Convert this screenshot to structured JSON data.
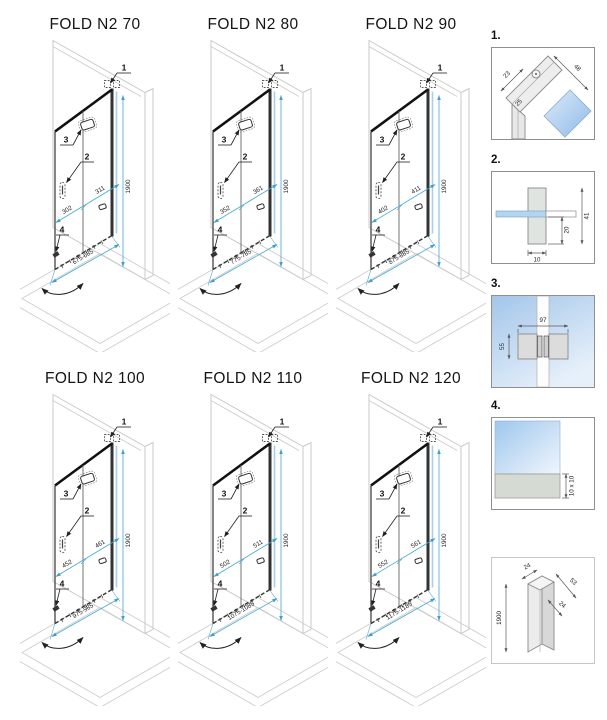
{
  "diagrams": [
    {
      "title": "FOLD N2 70",
      "dims": {
        "height": "1900",
        "door_panel": "311",
        "fixed_panel": "302",
        "total_width": "675-685"
      }
    },
    {
      "title": "FOLD N2 80",
      "dims": {
        "height": "1900",
        "door_panel": "361",
        "fixed_panel": "352",
        "total_width": "775-785"
      }
    },
    {
      "title": "FOLD N2 90",
      "dims": {
        "height": "1900",
        "door_panel": "411",
        "fixed_panel": "402",
        "total_width": "875-885"
      }
    },
    {
      "title": "FOLD N2 100",
      "dims": {
        "height": "1900",
        "door_panel": "461",
        "fixed_panel": "452",
        "total_width": "975-985"
      }
    },
    {
      "title": "FOLD N2 110",
      "dims": {
        "height": "1900",
        "door_panel": "511",
        "fixed_panel": "502",
        "total_width": "1075-1085"
      }
    },
    {
      "title": "FOLD N2 120",
      "dims": {
        "height": "1900",
        "door_panel": "561",
        "fixed_panel": "552",
        "total_width": "1175-1185"
      }
    }
  ],
  "callout_labels": [
    "1",
    "2",
    "3",
    "4"
  ],
  "details": [
    {
      "label": "1.",
      "dims": {
        "a": "23",
        "b": "48",
        "c": "25"
      }
    },
    {
      "label": "2.",
      "dims": {
        "width": "10",
        "inner": "20",
        "total": "41"
      }
    },
    {
      "label": "3.",
      "dims": {
        "width": "97",
        "height": "55"
      }
    },
    {
      "label": "4.",
      "dims": {
        "seal": "10 x 10"
      }
    },
    {
      "label": "",
      "dims": {
        "top": "24",
        "depth": "53",
        "inner": "24",
        "height": "1900"
      }
    }
  ],
  "colors": {
    "dimension_line": "#45a9d4",
    "glass_edge": "#a5d2e8",
    "outline_gray": "#c9c9c9",
    "dark_line": "#222222",
    "glass_fill": "#aacdef",
    "seal_fill": "#d5dbd3"
  }
}
